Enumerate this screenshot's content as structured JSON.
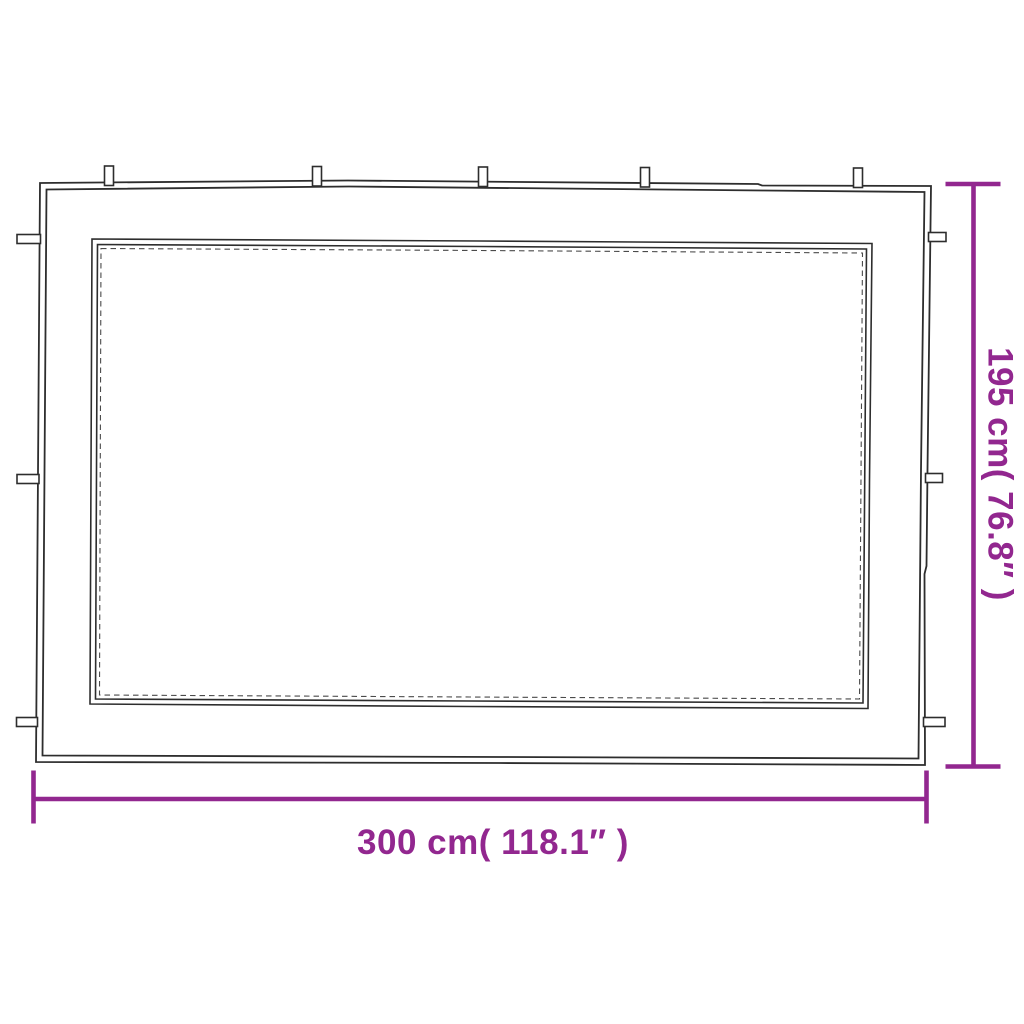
{
  "figure": {
    "background_color": "#ffffff",
    "outline_color": "#2d2d2d",
    "stitch_color": "#4a4a4a",
    "accent_color": "#92278F",
    "width_dimension": {
      "label": "300 cm( 118.1″ )",
      "cm": 300,
      "inches": 118.1
    },
    "height_dimension": {
      "label": "195 cm( 76.8″ )",
      "cm": 195,
      "inches": 76.8
    },
    "loops": {
      "top_count": 5,
      "left_count": 3,
      "right_count": 3
    }
  }
}
